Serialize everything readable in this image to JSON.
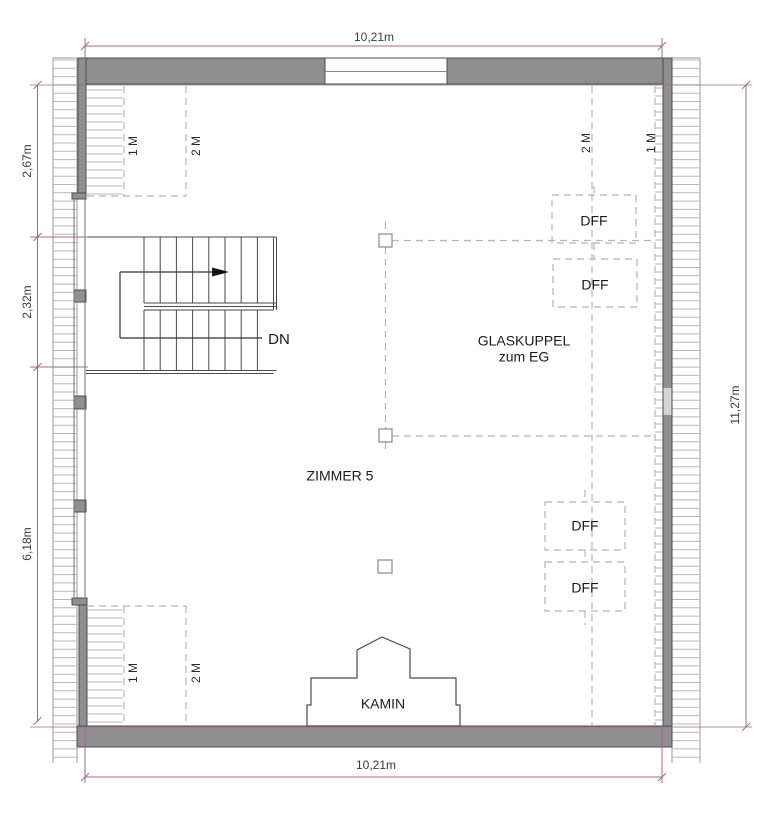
{
  "drawing": {
    "room_label": "ZIMMER 5",
    "skylight_label_line1": "GLASKUPPEL",
    "skylight_label_line2": "zum EG",
    "chimney_label": "KAMIN",
    "stair_direction_label": "DN",
    "roof_window_label": "DFF",
    "height_line_1m_label": "1 M",
    "height_line_2m_label": "2 M",
    "dimensions": {
      "top": "10,21m",
      "bottom": "10,21m",
      "right": "11,27m",
      "left_upper": "2,67m",
      "left_middle": "2,32m",
      "left_lower": "6,18m"
    },
    "colors": {
      "dimension_line": "#a4688a",
      "wall_fill": "#8f8f8f",
      "wall_stroke": "#4d4d4d",
      "hatch_line": "#b8b8b8",
      "dashed_line": "#b5b5b5",
      "faded_dim_text": "#9a9a9a"
    }
  }
}
